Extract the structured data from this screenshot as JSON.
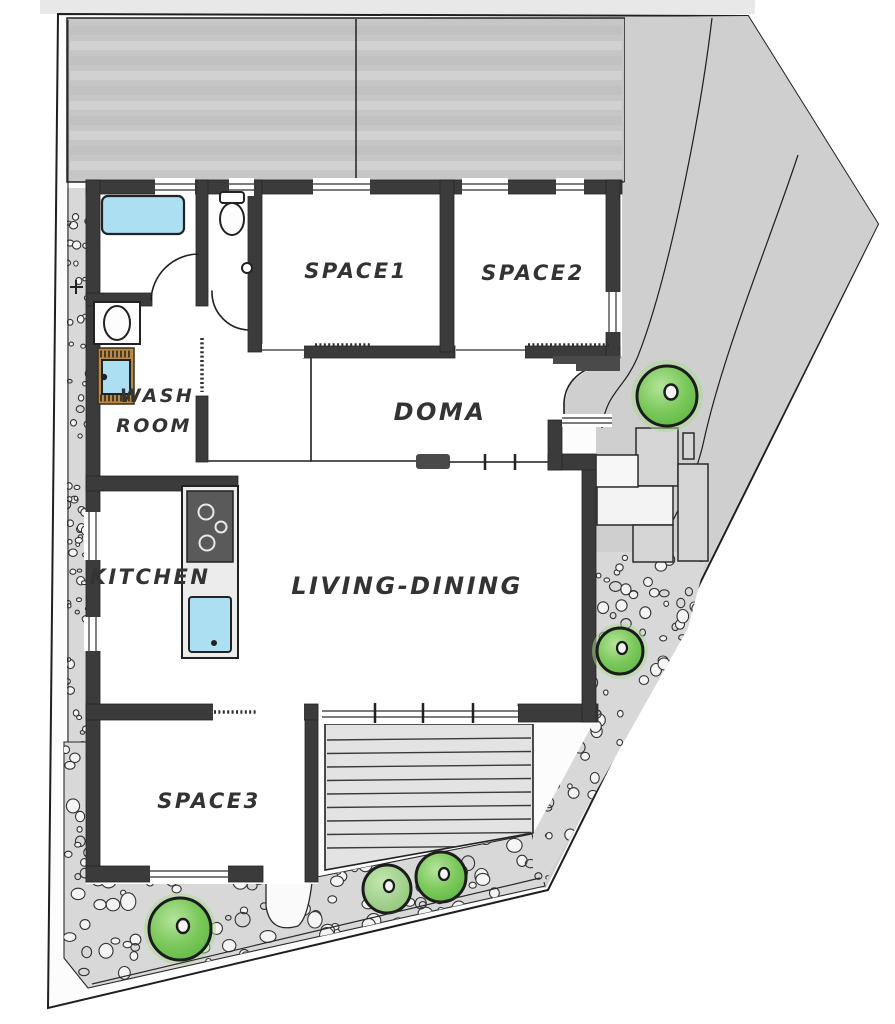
{
  "page": {
    "title": "Hand-drawn site and floor plan"
  },
  "rooms": {
    "space1": "SPACE1",
    "space2": "SPACE2",
    "space3": "SPACE3",
    "doma": "DOMA",
    "living_dining": "LIVING-DINING",
    "kitchen": "KITCHEN",
    "washroom_line1": "WASH",
    "washroom_line2": "ROOM"
  },
  "features": {
    "parking": "parking-area",
    "side_yard": "gravel-side-yard",
    "deck": "wood-deck",
    "walkway": "walkway",
    "stepping_stones": "stepping-stones",
    "trees": "garden-tree",
    "bathtub": "bathtub",
    "toilet": "toilet",
    "washing_machine": "washing-machine",
    "wash_basin": "wash-basin",
    "stove": "stove",
    "kitchen_sink": "kitchen-sink",
    "outdoor_faucet": "outdoor-faucet"
  },
  "colors": {
    "paper": "#ffffff",
    "site": "#fcfcfc",
    "ink": "#1f1f1f",
    "wall": "#3b3b3b",
    "driveway": "#c6c6c6",
    "yard": "#cfcfcf",
    "gravel": "#d8d8d8",
    "stone": "#f4f4f4",
    "deck": "#e3e3e3",
    "paver": "#d5d5d5",
    "paver-light": "#f3f3f3",
    "tree-fill": "#74c455",
    "tree-light": "#aadc92",
    "water": "#abdff1",
    "mat": "#b98b4a",
    "label": "#333333"
  }
}
